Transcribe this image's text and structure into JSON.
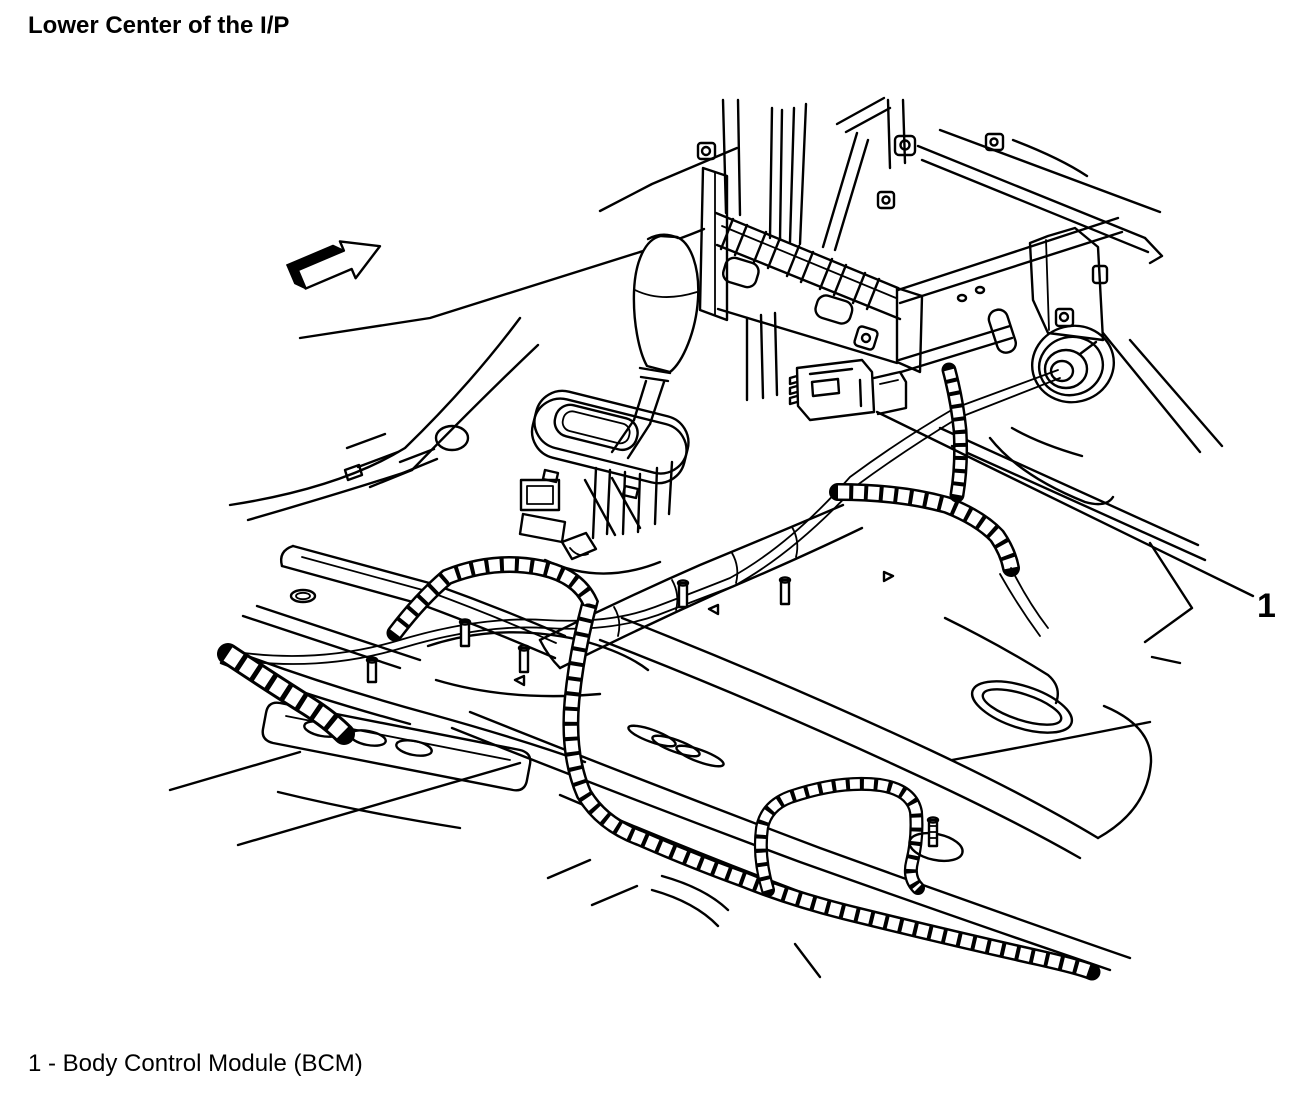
{
  "colors": {
    "paper": "#ffffff",
    "ink": "#000000"
  },
  "header": {
    "title": "Lower Center of the I/P"
  },
  "callout": {
    "number": "1"
  },
  "legend": {
    "line": "1 - Body Control Module (BCM)",
    "items": [
      {
        "number": "1",
        "label": "Body Control Module (BCM)"
      }
    ]
  }
}
